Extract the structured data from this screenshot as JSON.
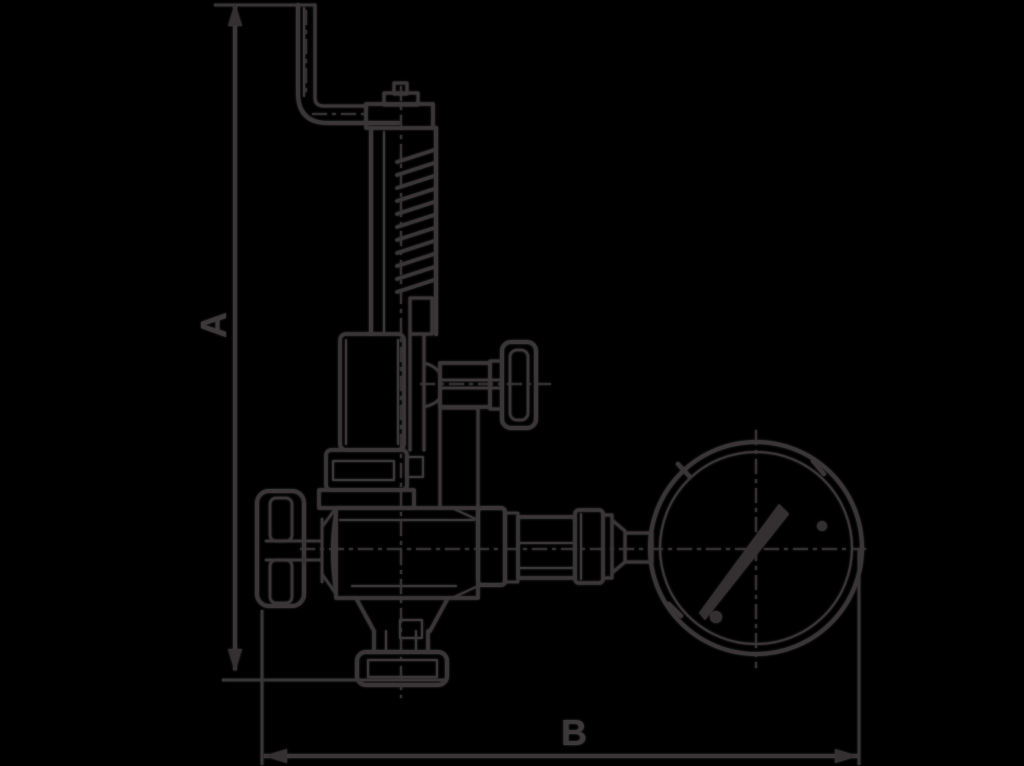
{
  "page": {
    "background": "#000000",
    "ink": "#231f20"
  },
  "drawing": {
    "type": "technical dimensioned line drawing",
    "subject": "spring safety relief valve with handwheels and pressure gauge",
    "dimension_a_label": "A",
    "dimension_b_label": "B"
  }
}
